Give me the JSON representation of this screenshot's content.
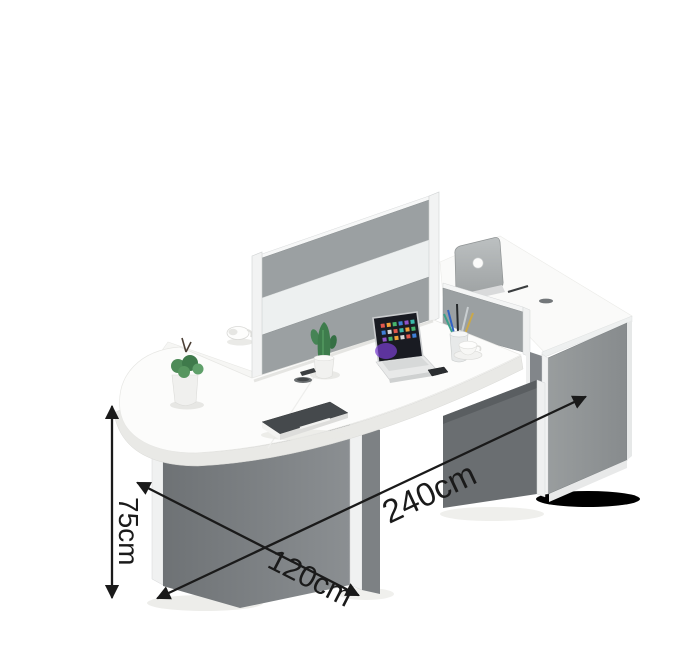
{
  "image": {
    "type": "product-photo",
    "subject": "Office workstation desk with rounded end, privacy divider screen and side cabinet",
    "background": "#ffffff"
  },
  "annotations": {
    "color": "#1a1a1a",
    "length": {
      "label": "240cm",
      "orientation": "diagonal-along-length"
    },
    "depth": {
      "label": "120cm",
      "orientation": "diagonal-along-depth"
    },
    "height": {
      "label": "75cm",
      "orientation": "vertical"
    }
  },
  "palette": {
    "background": "#ffffff",
    "desk_top": "#fcfcfb",
    "desk_edge": "#e9e9e6",
    "panel_dark": "#606467",
    "panel_mid": "#7d8184",
    "panel_light": "#8f9394",
    "divider_gray": "#9ba0a2",
    "divider_frost": "#edf0f0",
    "trim_white": "#f2f3f3",
    "cabinet_gray": "#8f9394",
    "annotation_black": "#1a1a1a",
    "plant_green": "#3e7c4c",
    "laptop_screen": "#191b22",
    "accent_purple": "#7a3fd1"
  },
  "scene_objects": [
    "rounded-end-desk",
    "privacy-divider-screen",
    "low-side-divider",
    "side-cabinet",
    "laptop",
    "smartphone",
    "monitor-back",
    "cactus-plant",
    "succulent-plant",
    "notebook",
    "pen-cup",
    "teacup",
    "coffee-cup"
  ]
}
